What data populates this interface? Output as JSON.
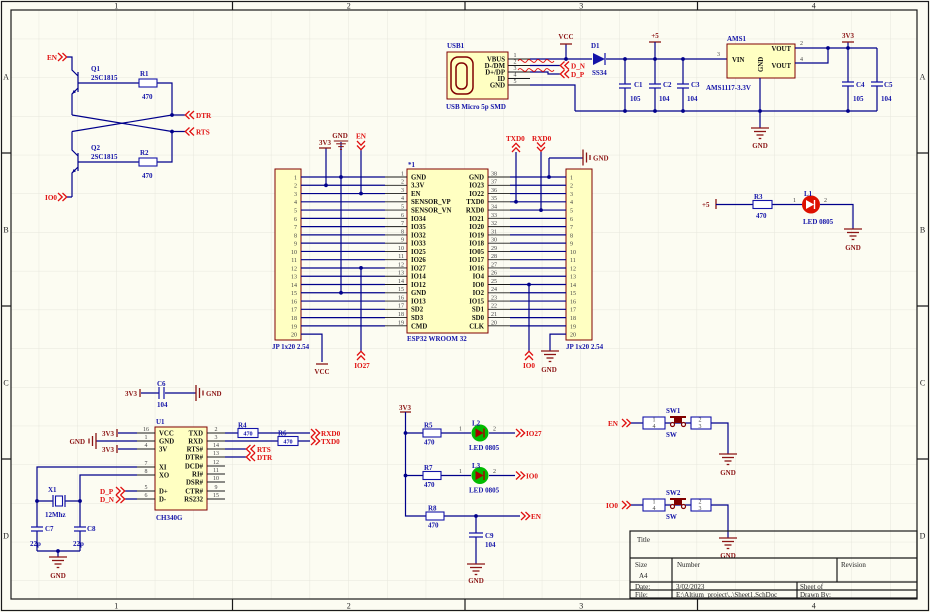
{
  "colors": {
    "wire": "#00008B",
    "component_outline": "#800000",
    "component_fill": "#FFFFC2",
    "symbol_blue": "#1414A8",
    "port_red": "#E01010",
    "power_dark_red": "#8B1414",
    "led_red": "#DD1000",
    "led_green": "#00BB00",
    "sheet_bg": "#FCFCF2",
    "grid": "#E6E6DC"
  },
  "sheet": {
    "border_numbers": [
      "1",
      "2",
      "3",
      "4"
    ],
    "border_letters": [
      "A",
      "B",
      "C",
      "D"
    ],
    "title_block": {
      "title_label": "Title",
      "size_label": "Size",
      "size_value": "A4",
      "number_label": "Number",
      "revision_label": "Revision",
      "date_label": "Date:",
      "date_value": "3/02/2023",
      "file_label": "File:",
      "file_value": "E:\\Altium_project\\..\\Sheet1.SchDoc",
      "sheet_label": "Sheet  of",
      "drawn_label": "Drawn By:"
    }
  },
  "q_circuit": {
    "en": "EN",
    "io0": "IO0",
    "dtr": "DTR",
    "rts": "RTS",
    "q1_ref": "Q1",
    "q1_part": "2SC1815",
    "q2_ref": "Q2",
    "q2_part": "2SC1815",
    "r1_ref": "R1",
    "r1_val": "470",
    "r2_ref": "R2",
    "r2_val": "470"
  },
  "usb": {
    "ref": "USB1",
    "part": "USB Micro 5p SMD",
    "pins": [
      {
        "num": "1",
        "name": "VBUS"
      },
      {
        "num": "2",
        "name": "D-/DM"
      },
      {
        "num": "3",
        "name": "D+/DP"
      },
      {
        "num": "4",
        "name": "ID"
      },
      {
        "num": "5",
        "name": "GND"
      }
    ],
    "vcc": "VCC",
    "d1_ref": "D1",
    "d1_part": "SS34",
    "dn": "D_N",
    "dp": "D_P"
  },
  "pwr_in": {
    "p5": "+5",
    "c1": "C1",
    "c1v": "105",
    "c2": "C2",
    "c2v": "104",
    "c3": "C3",
    "c3v": "104",
    "gnd": "GND"
  },
  "reg": {
    "ref": "AMS1",
    "part": "AMS1117-3.3V",
    "vin": "VIN",
    "gnd": "GND",
    "vout": "VOUT",
    "pin2": "2",
    "pin3": "3",
    "pin4": "4",
    "v33": "3V3",
    "c4": "C4",
    "c4v": "105",
    "c5": "C5",
    "c5v": "104",
    "gnd_lbl": "GND"
  },
  "esp32": {
    "designator": "*1",
    "part": "ESP32 WROOM 32",
    "header_label": "JP 1x20 2.54",
    "header_nums": [
      "1",
      "2",
      "3",
      "4",
      "5",
      "6",
      "7",
      "8",
      "9",
      "10",
      "11",
      "12",
      "13",
      "14",
      "15",
      "16",
      "17",
      "18",
      "19",
      "20"
    ],
    "left_pins": [
      {
        "num": "1",
        "name": "GND"
      },
      {
        "num": "2",
        "name": "3.3V"
      },
      {
        "num": "3",
        "name": "EN"
      },
      {
        "num": "4",
        "name": "SENSOR_VP"
      },
      {
        "num": "5",
        "name": "SENSOR_VN"
      },
      {
        "num": "6",
        "name": "IO34"
      },
      {
        "num": "7",
        "name": "IO35"
      },
      {
        "num": "8",
        "name": "IO32"
      },
      {
        "num": "9",
        "name": "IO33"
      },
      {
        "num": "10",
        "name": "IO25"
      },
      {
        "num": "11",
        "name": "IO26"
      },
      {
        "num": "12",
        "name": "IO27"
      },
      {
        "num": "13",
        "name": "IO14"
      },
      {
        "num": "14",
        "name": "IO12"
      },
      {
        "num": "15",
        "name": "GND"
      },
      {
        "num": "16",
        "name": "IO13"
      },
      {
        "num": "17",
        "name": "SD2"
      },
      {
        "num": "18",
        "name": "SD3"
      },
      {
        "num": "19",
        "name": "CMD"
      }
    ],
    "right_pins": [
      {
        "num": "38",
        "name": "GND"
      },
      {
        "num": "37",
        "name": "IO23"
      },
      {
        "num": "36",
        "name": "IO22"
      },
      {
        "num": "35",
        "name": "TXD0"
      },
      {
        "num": "34",
        "name": "RXD0"
      },
      {
        "num": "33",
        "name": "IO21"
      },
      {
        "num": "32",
        "name": "IO20"
      },
      {
        "num": "31",
        "name": "IO19"
      },
      {
        "num": "30",
        "name": "IO18"
      },
      {
        "num": "29",
        "name": "IO05"
      },
      {
        "num": "28",
        "name": "IO17"
      },
      {
        "num": "27",
        "name": "IO16"
      },
      {
        "num": "26",
        "name": "IO4"
      },
      {
        "num": "25",
        "name": "IO0"
      },
      {
        "num": "24",
        "name": "IO2"
      },
      {
        "num": "23",
        "name": "IO15"
      },
      {
        "num": "22",
        "name": "SD1"
      },
      {
        "num": "21",
        "name": "SD0"
      },
      {
        "num": "20",
        "name": "CLK"
      }
    ],
    "v33": "3V3",
    "gnd_top": "GND",
    "en": "EN",
    "txd0": "TXD0",
    "rxd0": "RXD0",
    "gnd_right": "GND",
    "vcc": "VCC",
    "io27": "IO27",
    "io0": "IO0",
    "gnd_bot": "GND"
  },
  "led1": {
    "p5": "+5",
    "r_ref": "R3",
    "r_val": "470",
    "pin1": "1",
    "pin2": "2",
    "ref": "L1",
    "part": "LED 0805",
    "gnd": "GND"
  },
  "ch340": {
    "ref": "U1",
    "part": "CH340G",
    "left_pins": [
      {
        "num": "16",
        "name": "VCC"
      },
      {
        "num": "1",
        "name": "GND"
      },
      {
        "num": "4",
        "name": "3V"
      },
      {
        "num": "7",
        "name": "XI"
      },
      {
        "num": "8",
        "name": "XO"
      },
      {
        "num": "5",
        "name": "D+"
      },
      {
        "num": "6",
        "name": "D-"
      }
    ],
    "right_pins": [
      {
        "num": "2",
        "name": "TXD"
      },
      {
        "num": "3",
        "name": "RXD"
      },
      {
        "num": "14",
        "name": "RTS#"
      },
      {
        "num": "13",
        "name": "DTR#"
      },
      {
        "num": "12",
        "name": "DCD#"
      },
      {
        "num": "11",
        "name": "RI#"
      },
      {
        "num": "10",
        "name": "DSR#"
      },
      {
        "num": "9",
        "name": "CTR#"
      },
      {
        "num": "15",
        "name": "RS232"
      }
    ],
    "v33_1": "3V3",
    "gnd1": "GND",
    "v33_2": "3V3",
    "dp": "D_P",
    "dn": "D_N",
    "c6": {
      "v33": "3V3",
      "ref": "C6",
      "val": "104",
      "gnd": "GND"
    },
    "xtal": {
      "ref": "X1",
      "part": "12Mhz",
      "c7": "C7",
      "c7v": "22p",
      "c8": "C8",
      "c8v": "22p",
      "gnd": "GND"
    },
    "r4_ref": "R4",
    "r4_val": "470",
    "r6_ref": "R6",
    "r6_val": "470",
    "rxd0": "RXD0",
    "txd0": "TXD0",
    "rts": "RTS",
    "dtr": "DTR"
  },
  "leds": {
    "v33": "3V3",
    "pin1": "1",
    "pin2": "2",
    "r5_ref": "R5",
    "r5_val": "470",
    "l2_ref": "L2",
    "l2_part": "LED 0805",
    "io27": "IO27",
    "r7_ref": "R7",
    "r7_val": "470",
    "l3_ref": "L3",
    "l3_part": "LED 0805",
    "io0": "IO0",
    "r8_ref": "R8",
    "r8_val": "470",
    "en": "EN",
    "c9": "C9",
    "c9v": "104",
    "gnd": "GND"
  },
  "sw": {
    "sw1_port": "EN",
    "sw1_ref": "SW1",
    "sw1_part": "SW",
    "sw2_port": "IO0",
    "sw2_ref": "SW2",
    "sw2_part": "SW",
    "p1": "1",
    "p2": "2",
    "p3": "3",
    "p4": "4",
    "gnd": "GND"
  }
}
